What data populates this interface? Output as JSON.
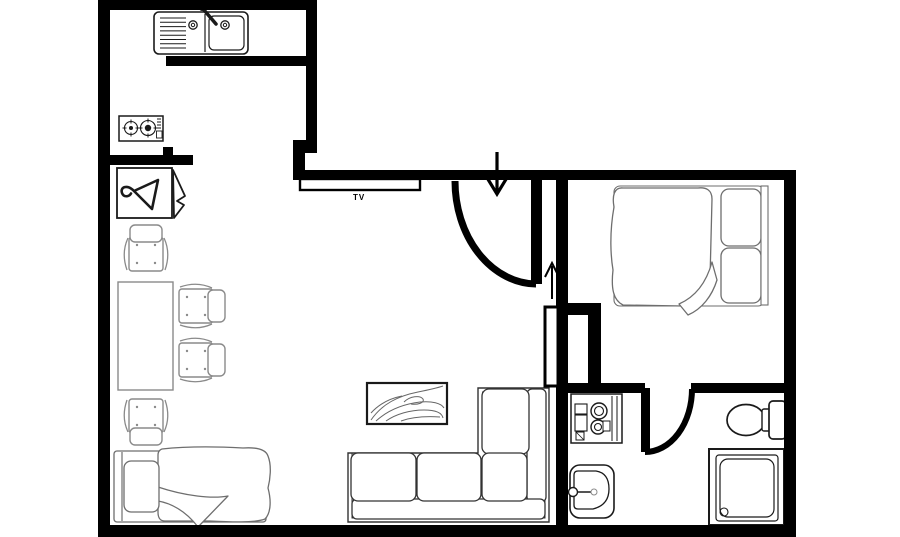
{
  "labels": {
    "tv": "TV"
  },
  "colors": {
    "wall": "#000000",
    "background": "#ffffff",
    "fixture_stroke": "#1a1a1a",
    "furniture_stroke": "#8a8a8a",
    "bed_stroke": "#6e6e6e",
    "sofa_stroke": "#333333",
    "rug_detail": "#666666"
  },
  "fixtures": [
    "kitchen-sink-icon",
    "cooktop-icon",
    "wardrobe-hanger-icon",
    "dining-table-icon",
    "dining-chair-icon",
    "tv-icon",
    "entry-door-swing-icon",
    "entrance-arrow-down-icon",
    "hall-arrow-up-icon",
    "sliding-door-leaf-icon",
    "double-bed-icon",
    "rug-icon",
    "sectional-sofa-icon",
    "single-bed-icon",
    "washing-machine-icon",
    "bathroom-door-swing-icon",
    "toilet-icon",
    "shower-icon",
    "washbasin-icon"
  ]
}
